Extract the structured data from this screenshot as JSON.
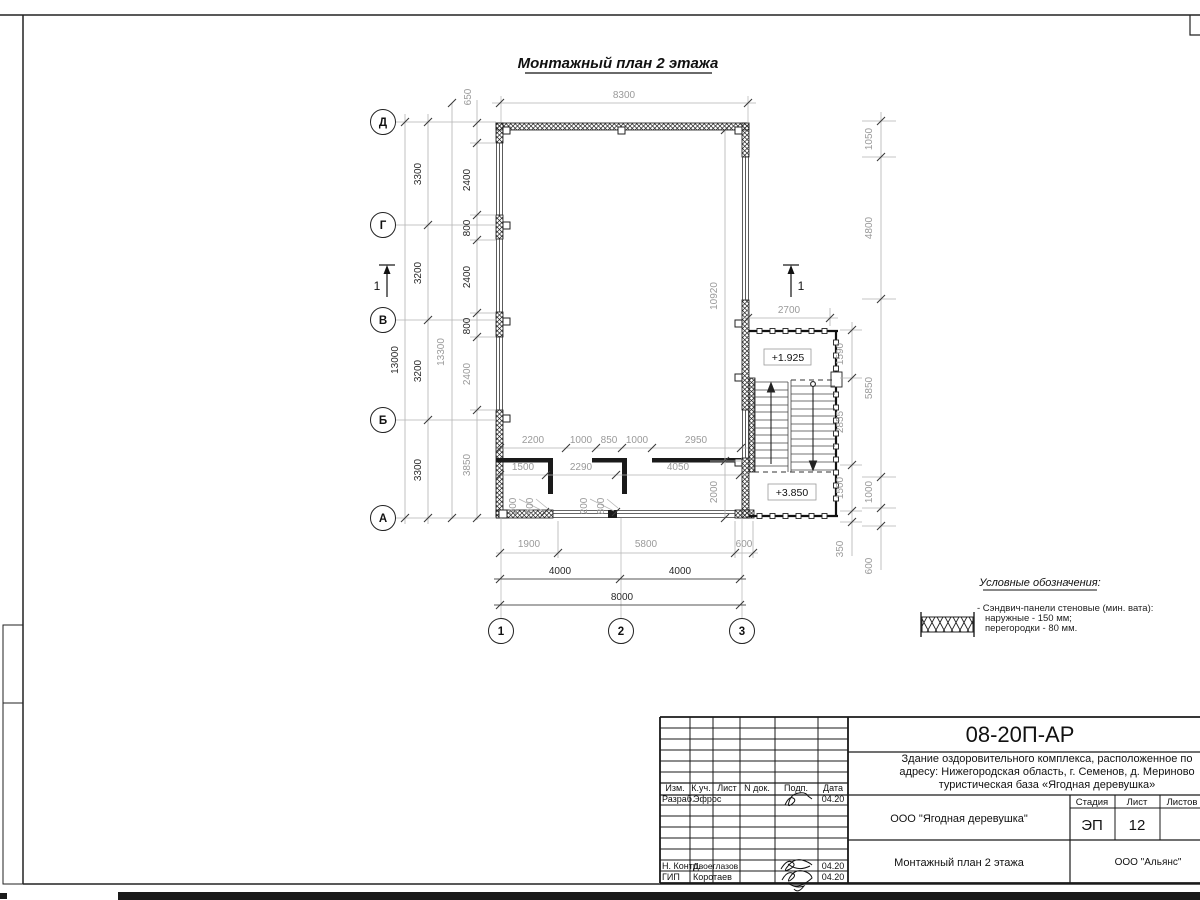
{
  "plan_title": "Монтажный план 2 этажа",
  "axes": {
    "rows": [
      "Д",
      "Г",
      "В",
      "Б",
      "А"
    ],
    "cols": [
      "1",
      "2",
      "3"
    ]
  },
  "section_label": "1",
  "levels": {
    "landing": "+1.925",
    "upper": "+3.850"
  },
  "dims": {
    "top": {
      "w8300": "8300",
      "off650": "650"
    },
    "left": {
      "total": "13000",
      "overall": "13300",
      "axis": [
        "3300",
        "3200",
        "3200",
        "3300"
      ],
      "wall": [
        "2400",
        "800",
        "2400",
        "800",
        "2400",
        "3850"
      ]
    },
    "right": {
      "outer": [
        "1050",
        "4800",
        "5850",
        "1000",
        "600"
      ],
      "stair": [
        "1590",
        "2855",
        "1500",
        "350"
      ],
      "stair_w": "2700"
    },
    "inner": {
      "h10920": "10920",
      "v2000": "2000"
    },
    "partitions": {
      "row1": [
        "2200",
        "1000",
        "850",
        "1000",
        "2950"
      ],
      "row2": [
        "1500",
        "2290",
        "4050"
      ],
      "doors": [
        "200",
        "800",
        "200",
        "800"
      ]
    },
    "bottom": {
      "chain": [
        "1900",
        "5800",
        "600"
      ],
      "mid": [
        "4000",
        "4000"
      ],
      "total": "8000"
    }
  },
  "legend": {
    "title": "Условные обозначения:",
    "line1": "- Сэндвич-панели стеновые (мин. вата):",
    "line2": "наружные - 150 мм;",
    "line3": "перегородки - 80 мм."
  },
  "titleblock": {
    "code": "08-20П-АР",
    "desc1": "Здание оздоровительного комплекса, расположенное по",
    "desc2": "адресу: Нижегородская область, г. Семенов, д. Мериново",
    "desc3": "туристическая база «Ягодная деревушка»",
    "cols": [
      "Изм.",
      "К.уч.",
      "Лист",
      "N док.",
      "Подп.",
      "Дата"
    ],
    "roles": {
      "dev": "Разраб.",
      "ncontr": "Н. Контр.",
      "gip": "ГИП"
    },
    "names": {
      "dev": "Эфрос",
      "ncontr": "Двоеглазов",
      "gip": "Коротаев"
    },
    "dates": [
      "04.20",
      "04.20",
      "04.20"
    ],
    "stage_labels": [
      "Стадия",
      "Лист",
      "Листов"
    ],
    "stage": "ЭП",
    "sheet_no": "12",
    "org": "ООО \"Ягодная деревушка\"",
    "plan_name": "Монтажный план 2 этажа",
    "company": "ООО \"Альянс\""
  }
}
